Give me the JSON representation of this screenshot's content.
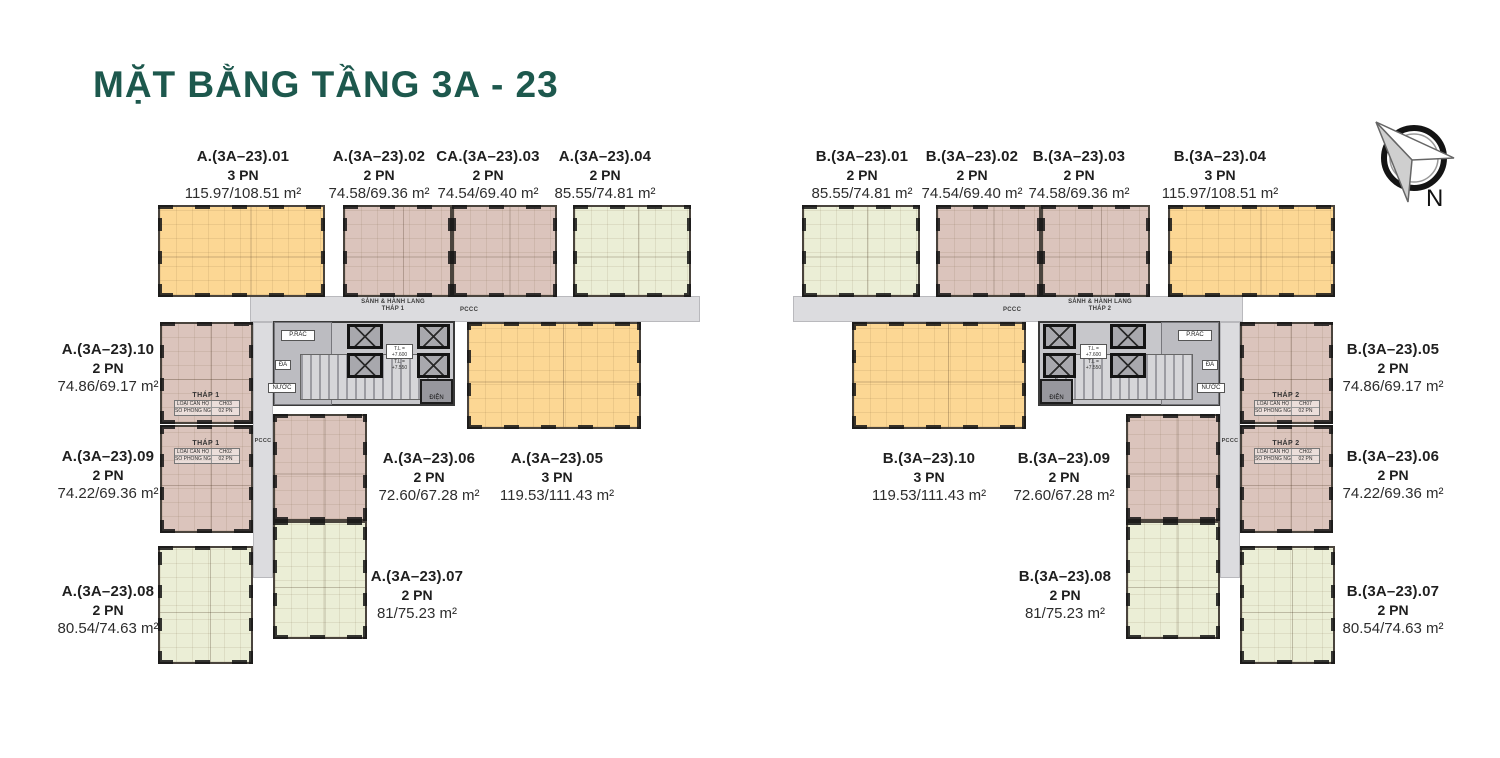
{
  "page": {
    "title": "MẶT BẰNG TẦNG 3A - 23"
  },
  "palette": {
    "title_color": "#1d584d",
    "unit_orange": "#fcd794",
    "unit_rose": "#dbc4bc",
    "unit_green": "#ebeed6",
    "corridor_gray": "#dcdcdf",
    "core_gray": "#c7c7cb",
    "wall_black": "#161616"
  },
  "compass": {
    "label": "N"
  },
  "corridors": {
    "a": {
      "line1": "SẢNH & HÀNH LANG",
      "line2": "THÁP 1",
      "pccc": "PCCC",
      "pccc_shaft": "PCCC"
    },
    "b": {
      "line1": "SẢNH & HÀNH LANG",
      "line2": "THÁP 2",
      "pccc": "PCCC",
      "pccc_shaft": "PCCC"
    }
  },
  "cores": {
    "a": {
      "trash": "P.RÁC",
      "da": "ĐA",
      "water": "NƯỚC",
      "electric": "ĐIỆN",
      "level1": "T.L = +7.600",
      "level2": "T.L = +7.550"
    },
    "b": {
      "trash": "P.RÁC",
      "da": "ĐA",
      "water": "NƯỚC",
      "electric": "ĐIỆN",
      "level1": "T.L = +7.600",
      "level2": "T.L = +7.550"
    }
  },
  "unit_tags": {
    "a10": {
      "tower": "THÁP 1",
      "type_label": "LOẠI CĂN HỘ",
      "type": "CH03",
      "bed_label": "SỐ PHÒNG NGỦ",
      "bed": "02 PN"
    },
    "a09": {
      "tower": "THÁP 1",
      "type_label": "LOẠI CĂN HỘ",
      "type": "CH02",
      "bed_label": "SỐ PHÒNG NGỦ",
      "bed": "02 PN"
    },
    "b05": {
      "tower": "THÁP 2",
      "type_label": "LOẠI CĂN HỘ",
      "type": "CH07",
      "bed_label": "SỐ PHÒNG NGỦ",
      "bed": "02 PN"
    },
    "b06": {
      "tower": "THÁP 2",
      "type_label": "LOẠI CĂN HỘ",
      "type": "CH02",
      "bed_label": "SỐ PHÒNG NGỦ",
      "bed": "02 PN"
    }
  },
  "units": {
    "a01": {
      "code": "A.(3A–23).01",
      "pn": "3 PN",
      "area": "115.97/108.51 m²"
    },
    "a02": {
      "code": "A.(3A–23).02",
      "pn": "2 PN",
      "area": "74.58/69.36 m²"
    },
    "a03": {
      "code": "CA.(3A–23).03",
      "pn": "2 PN",
      "area": "74.54/69.40 m²"
    },
    "a04": {
      "code": "A.(3A–23).04",
      "pn": "2 PN",
      "area": "85.55/74.81 m²"
    },
    "a05": {
      "code": "A.(3A–23).05",
      "pn": "3 PN",
      "area": "119.53/111.43 m²"
    },
    "a06": {
      "code": "A.(3A–23).06",
      "pn": "2 PN",
      "area": "72.60/67.28 m²"
    },
    "a07": {
      "code": "A.(3A–23).07",
      "pn": "2 PN",
      "area": "81/75.23 m²"
    },
    "a08": {
      "code": "A.(3A–23).08",
      "pn": "2 PN",
      "area": "80.54/74.63 m²"
    },
    "a09": {
      "code": "A.(3A–23).09",
      "pn": "2 PN",
      "area": "74.22/69.36 m²"
    },
    "a10": {
      "code": "A.(3A–23).10",
      "pn": "2 PN",
      "area": "74.86/69.17 m²"
    },
    "b01": {
      "code": "B.(3A–23).01",
      "pn": "2 PN",
      "area": "85.55/74.81 m²"
    },
    "b02": {
      "code": "B.(3A–23).02",
      "pn": "2 PN",
      "area": "74.54/69.40 m²"
    },
    "b03": {
      "code": "B.(3A–23).03",
      "pn": "2 PN",
      "area": "74.58/69.36 m²"
    },
    "b04": {
      "code": "B.(3A–23).04",
      "pn": "3 PN",
      "area": "115.97/108.51 m²"
    },
    "b05": {
      "code": "B.(3A–23).05",
      "pn": "2 PN",
      "area": "74.86/69.17 m²"
    },
    "b06": {
      "code": "B.(3A–23).06",
      "pn": "2 PN",
      "area": "74.22/69.36 m²"
    },
    "b07": {
      "code": "B.(3A–23).07",
      "pn": "2 PN",
      "area": "80.54/74.63 m²"
    },
    "b08": {
      "code": "B.(3A–23).08",
      "pn": "2 PN",
      "area": "81/75.23 m²"
    },
    "b09": {
      "code": "B.(3A–23).09",
      "pn": "2 PN",
      "area": "72.60/67.28 m²"
    },
    "b10": {
      "code": "B.(3A–23).10",
      "pn": "3 PN",
      "area": "119.53/111.43 m²"
    }
  }
}
